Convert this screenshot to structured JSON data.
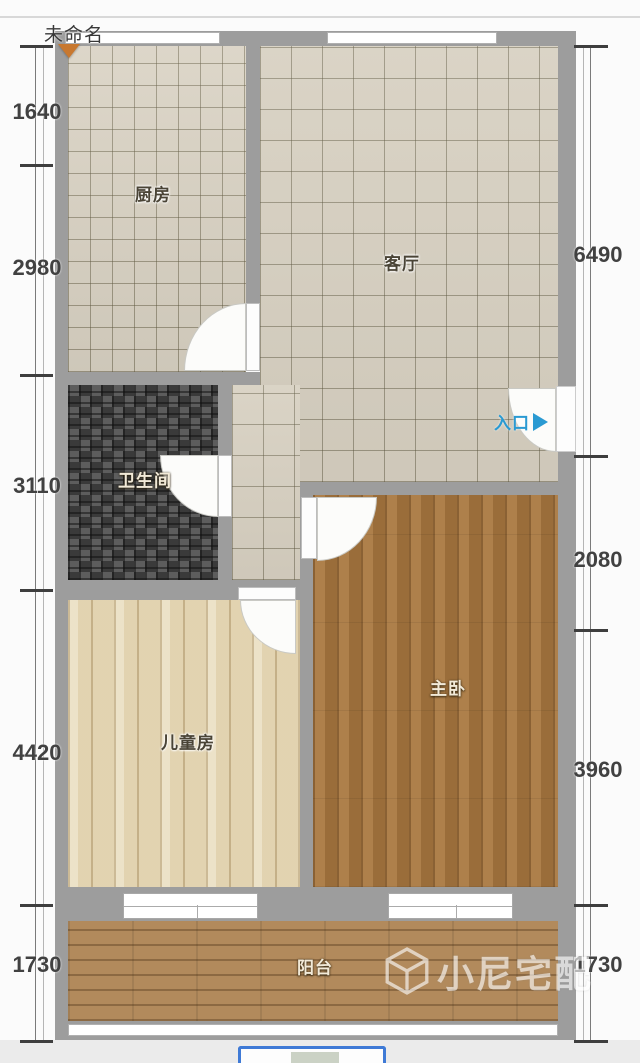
{
  "plan": {
    "name": "未命名"
  },
  "rooms": {
    "kitchen": {
      "label": "厨房"
    },
    "living": {
      "label": "客厅"
    },
    "bathroom": {
      "label": "卫生间"
    },
    "master": {
      "label": "主卧"
    },
    "kids": {
      "label": "儿童房"
    },
    "balcony": {
      "label": "阳台"
    }
  },
  "entrance": {
    "label": "入口",
    "arrow_icon": "right-triangle"
  },
  "dims": {
    "left": [
      "1640",
      "2980",
      "3110",
      "4420",
      "1730"
    ],
    "right": [
      "6490",
      "2080",
      "3960",
      "1730"
    ]
  },
  "watermark": {
    "brand": "小尼宅配",
    "icon": "cube-logo"
  },
  "colors": {
    "wall": "#9d9d9d",
    "entrance_blue": "#2a9ad2",
    "button_border": "#3f7ad6",
    "tile_floor": "#d8d1c2",
    "wood_dark": "#a97840",
    "wood_light": "#e9ddbe",
    "deck": "#b28a5c",
    "mosaic": "#4a4a4a",
    "marker_orange": "#c8782f"
  }
}
